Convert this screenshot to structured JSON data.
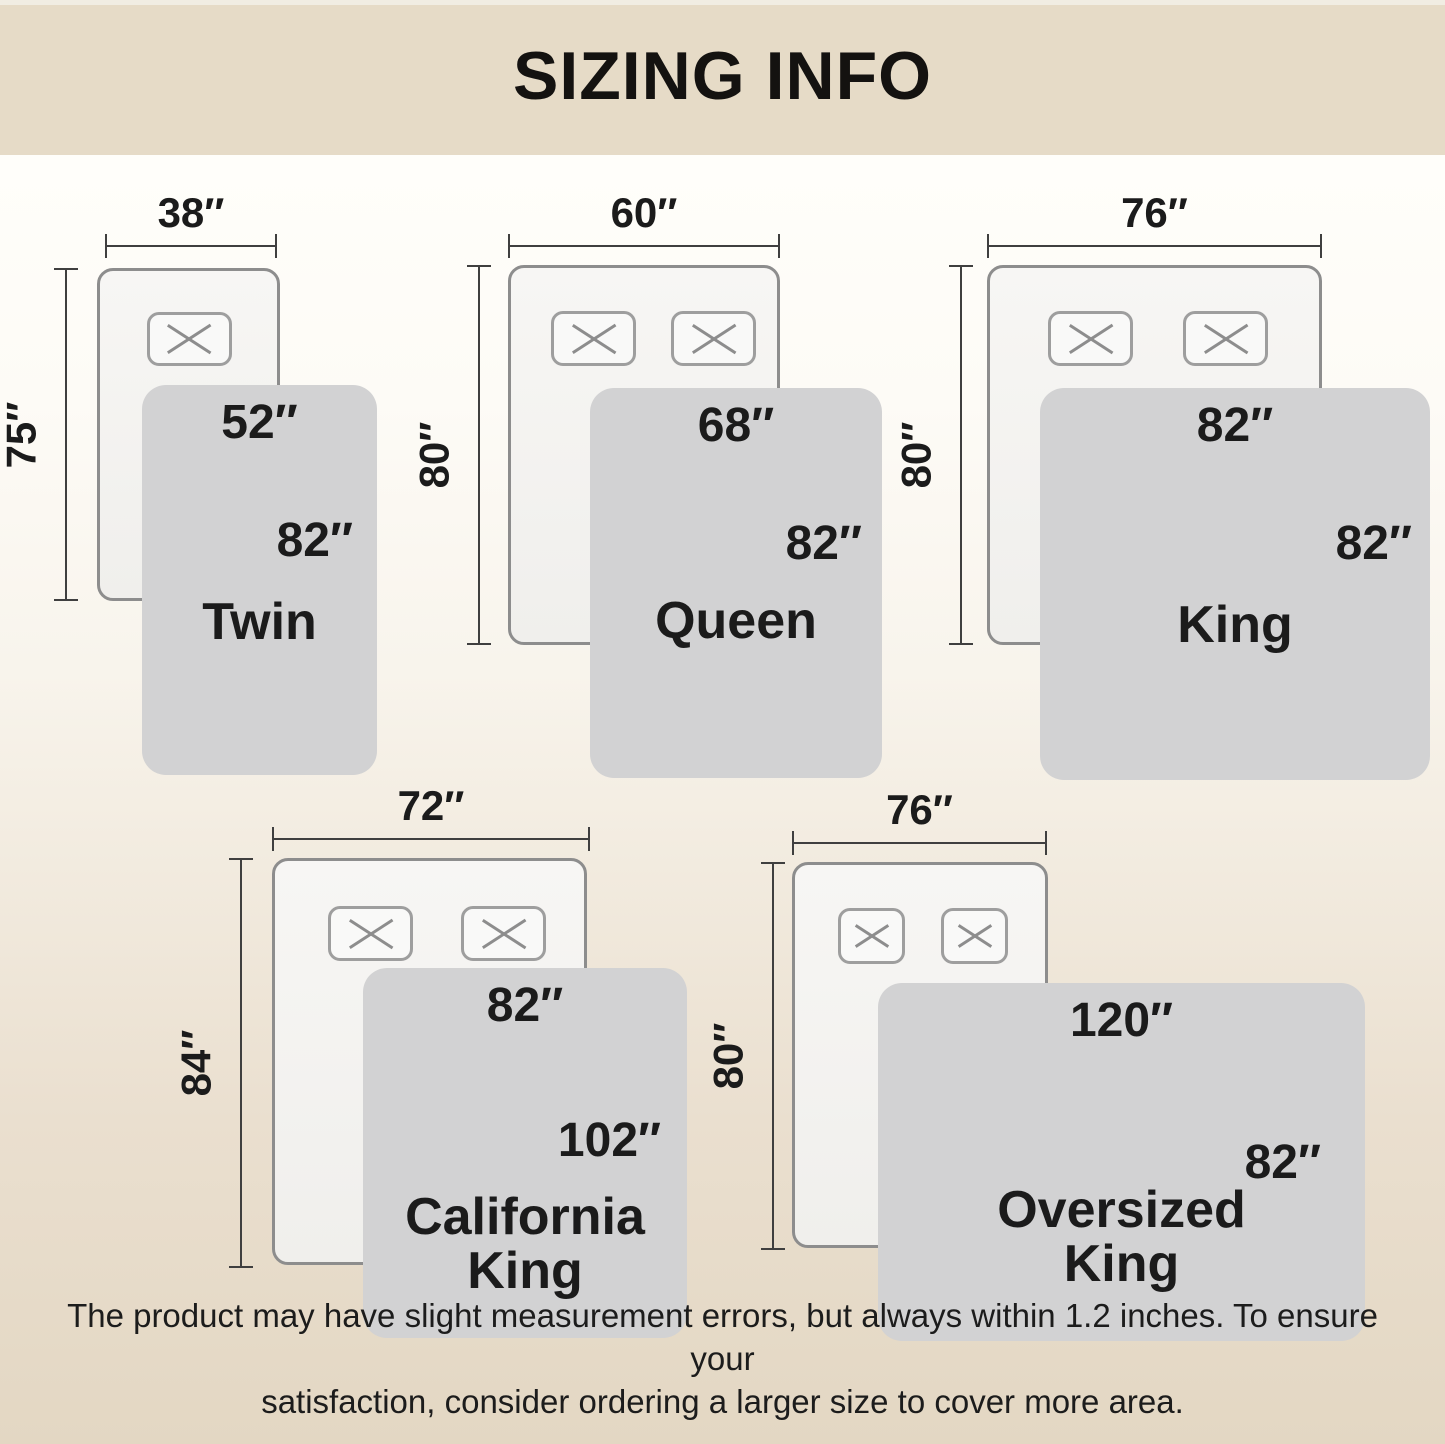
{
  "title": "SIZING INFO",
  "footer_text": "The product may have slight measurement errors, but always within 1.2 inches. To ensure your\nsatisfaction, consider ordering a larger size to cover more area.",
  "sizes": [
    {
      "id": "twin",
      "name": "Twin",
      "bed_width": "38″",
      "bed_length": "75″",
      "blanket_width": "52″",
      "blanket_length": "82″",
      "pillow_count": 1
    },
    {
      "id": "queen",
      "name": "Queen",
      "bed_width": "60″",
      "bed_length": "80″",
      "blanket_width": "68″",
      "blanket_length": "82″",
      "pillow_count": 2
    },
    {
      "id": "king",
      "name": "King",
      "bed_width": "76″",
      "bed_length": "80″",
      "blanket_width": "82″",
      "blanket_length": "82″",
      "pillow_count": 2
    },
    {
      "id": "california-king",
      "name": "California\nKing",
      "bed_width": "72″",
      "bed_length": "84″",
      "blanket_width": "82″",
      "blanket_length": "102″",
      "pillow_count": 2
    },
    {
      "id": "oversized-king",
      "name": "Oversized\nKing",
      "bed_width": "76″",
      "bed_length": "80″",
      "blanket_width": "120″",
      "blanket_length": "82″",
      "pillow_count": 2
    }
  ],
  "colors": {
    "header_bg": "#e6dbc7",
    "background_top": "#fffefa",
    "background_bottom": "#e3d7c3",
    "bed_fill": "#f5f4f2",
    "bed_border": "#8d8d8d",
    "blanket_fill": "#d2d2d3",
    "dimension_line": "#3f3f3f",
    "text": "#1b1b1b"
  }
}
